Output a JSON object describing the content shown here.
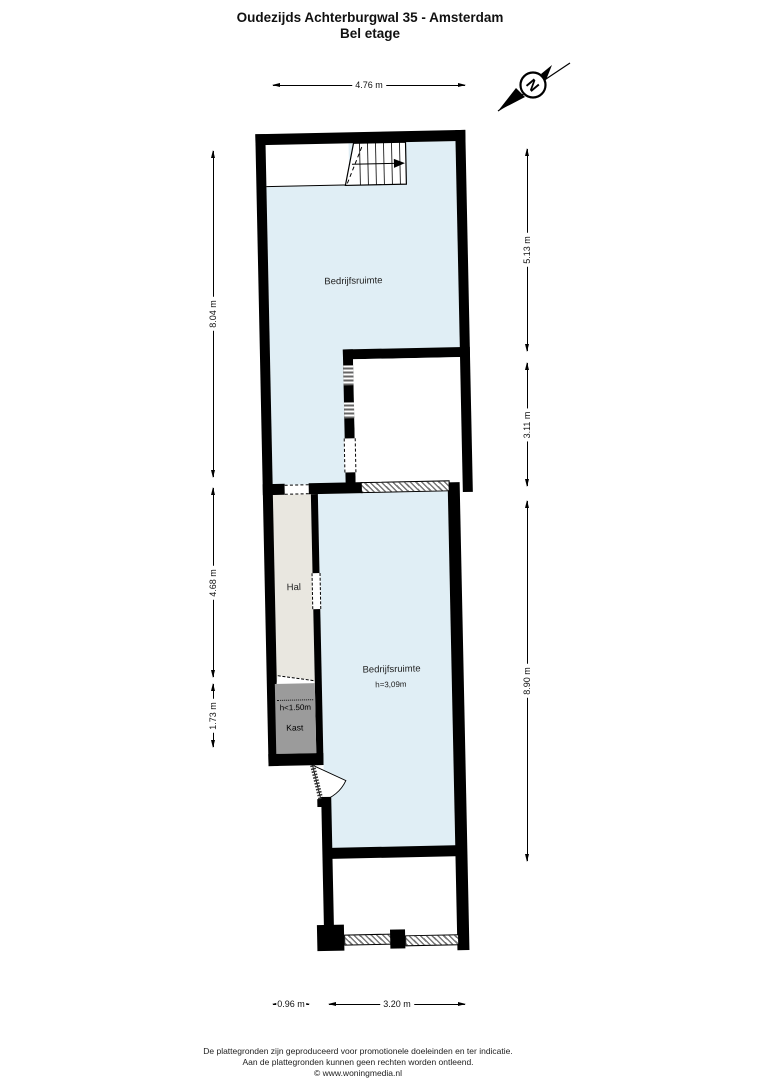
{
  "title": {
    "line1": "Oudezijds Achterburgwal 35 - Amsterdam",
    "line2": "Bel etage"
  },
  "compass": {
    "north_label": "N"
  },
  "dimensions": {
    "top": "4.76 m",
    "left": [
      "8.04 m",
      "4.68 m",
      "1.73 m"
    ],
    "right": [
      "5.13 m",
      "3.11 m",
      "8.90 m"
    ],
    "bottom": [
      "0.96 m",
      "3.20 m"
    ]
  },
  "rooms": {
    "upper": {
      "label": "Bedrijfsruimte"
    },
    "hal": {
      "label": "Hal"
    },
    "kast": {
      "label": "Kast",
      "height_note": "h<1.50m"
    },
    "lower": {
      "label": "Bedrijfsruimte",
      "height_note": "h=3,09m"
    }
  },
  "colors": {
    "room_fill": "#e0eef5",
    "hal_fill": "#e9e7e0",
    "kast_fill": "#9b9b9b",
    "wall": "#000000"
  },
  "footer": {
    "line1": "De plattegronden zijn geproduceerd voor promotionele doeleinden en ter indicatie.",
    "line2": "Aan de plattegronden kunnen geen rechten worden ontleend.",
    "line3": "© www.woningmedia.nl"
  }
}
